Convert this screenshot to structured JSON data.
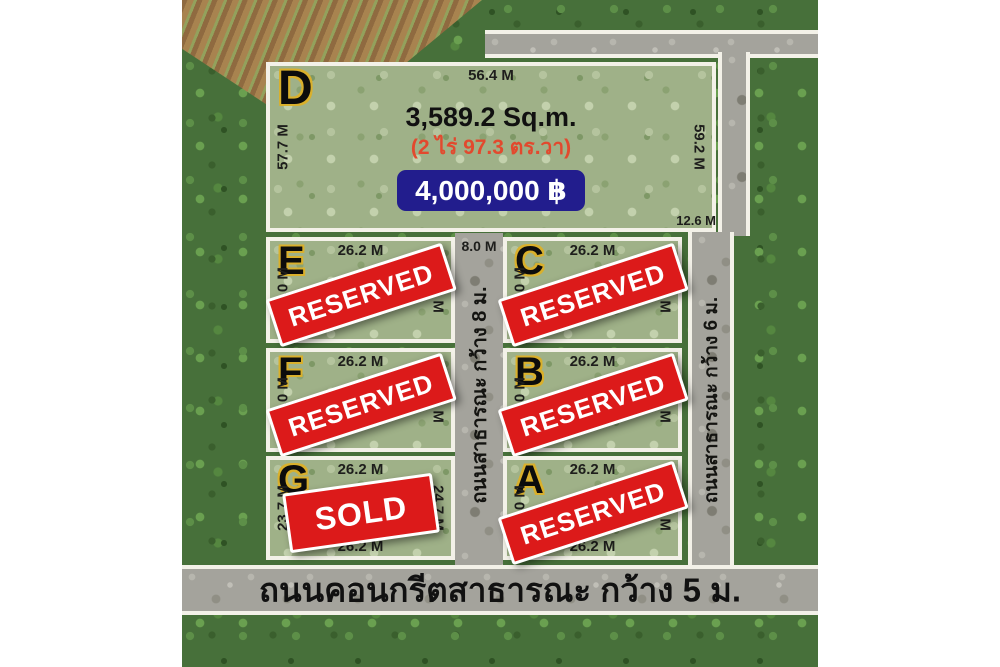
{
  "title_plot": {
    "label": "D",
    "top_m": "56.4 M",
    "left_m": "57.7 M",
    "right_m": "59.2 M",
    "bottom_right_m": "12.6 M",
    "area_sqm": "3,589.2 Sq.m.",
    "area_thai": "(2 ไร่ 97.3 ตร.วา)",
    "price": "4,000,000 ฿"
  },
  "plots": [
    {
      "label": "E",
      "top": "26.2 M",
      "left": "24.0 M",
      "right": "24.0 M",
      "status": "RESERVED"
    },
    {
      "label": "C",
      "top": "26.2 M",
      "left": "24.0 M",
      "right": "24.0 M",
      "status": "RESERVED"
    },
    {
      "label": "F",
      "top": "26.2 M",
      "left": "24.0 M",
      "right": "24.0 M",
      "status": "RESERVED"
    },
    {
      "label": "B",
      "top": "26.2 M",
      "left": "24.0 M",
      "right": "24.0 M",
      "status": "RESERVED"
    },
    {
      "label": "G",
      "top": "26.2 M",
      "left": "23.7 M",
      "right": "24.7 M",
      "bottom": "26.2 M",
      "status": "SOLD"
    },
    {
      "label": "A",
      "top": "26.2 M",
      "left": "25.0 M",
      "right": "26.1 M",
      "bottom": "26.2 M",
      "status": "RESERVED"
    }
  ],
  "roads": {
    "middle": {
      "width_label": "8.0 M",
      "name": "ถนนสาธารณะ กว้าง 8 ม."
    },
    "right": {
      "name": "ถนนสาธารณะ กว้าง 6 ม."
    },
    "bottom": {
      "name": "ถนนคอนกรีตสาธารณะ กว้าง 5 ม."
    }
  },
  "colors": {
    "stamp_red": "#dc1a1a",
    "price_navy": "#221d8d",
    "label_gold": "#d9b02c",
    "thai_red": "#e2492e",
    "road_gray": "#a4a39c"
  }
}
